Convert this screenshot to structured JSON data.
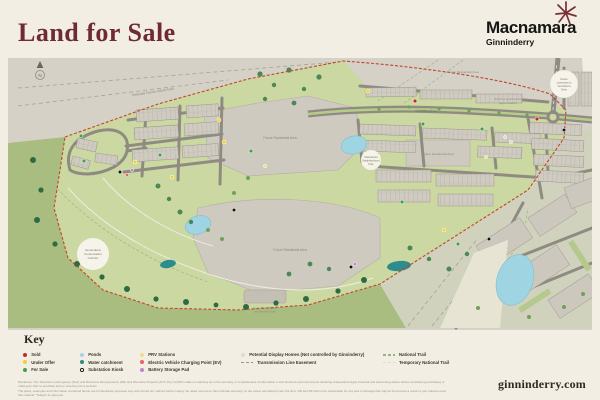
{
  "page": {
    "background": "#f2eee4"
  },
  "header": {
    "title": "Land for Sale",
    "title_color": "#6e2b33",
    "logo_name": "Macnamara",
    "logo_sub": "Ginninderry",
    "logo_star_color": "#7a2e35"
  },
  "map": {
    "compass": "N",
    "labels": {
      "potential_future_urban_area": "Potential Future Urban Area",
      "future_residential": "Future Residential Area",
      "future_local_centre": "Future Local Centre",
      "future_local_centre_sub": "(approx location)",
      "corridor_line1": "Ginninderra",
      "corridor_line2": "Conservation",
      "corridor_line3": "Corridor",
      "park_line1": "Macnamara",
      "park_line2": "Neighbourhood",
      "park_line3": "Park",
      "badge_line1": "Future",
      "badge_line2": "connection to",
      "badge_line3": "Ginninderra",
      "badge_line4": "Drive",
      "sewer_line1": "Sewer Pump Station",
      "sewer_line2": "and Network Store",
      "avenue": "Ginninderry Drive"
    },
    "colors": {
      "urban_gray": "#d6d1c7",
      "estate_park_green": "#ccd8a2",
      "corridor_green": "#a9bd80",
      "cleared_pale": "#d0d2bd",
      "pond_blue": "#9fd4e2",
      "catchment_teal": "#2d8c8c",
      "boundary_red": "#c1452c",
      "road_gray": "#8f8b83"
    }
  },
  "key": {
    "heading": "Key",
    "items": [
      {
        "label": "Sold",
        "color": "#c62828",
        "type": "dot"
      },
      {
        "label": "Under Offer",
        "color": "#f3d02f",
        "type": "dot"
      },
      {
        "label": "For Sale",
        "color": "#43a047",
        "type": "dot"
      },
      {
        "label": "Ponds",
        "color": "#a6d3e3",
        "type": "dot"
      },
      {
        "label": "Water catchment",
        "color": "#2d8c8c",
        "type": "dot"
      },
      {
        "label": "Substation Kiosk",
        "color": "#111111",
        "type": "kiosk"
      },
      {
        "label": "PRV Stations",
        "color": "#f2dc8c",
        "type": "dot"
      },
      {
        "label": "Electric Vehicle Charging Point (EV)",
        "color": "#e8655c",
        "type": "dot"
      },
      {
        "label": "Battery Storage Pad",
        "color": "#bb86c8",
        "type": "dot"
      },
      {
        "label": "Potential Display Homes (Not controlled by Ginninderry)",
        "color": "#dddbd2",
        "type": "dot"
      },
      {
        "label": "Transmission Line Easement",
        "color": "#9a958a",
        "type": "dash"
      },
      {
        "label": "National Trail",
        "color": "#93b687",
        "type": "dash"
      },
      {
        "label": "Temporary National Trail",
        "color": "#dfddc6",
        "type": "dash"
      }
    ]
  },
  "footer": {
    "disclaimer_line1": "Disclaimer: The Suburban Land Agency (SLA) and Riverview Developments (RD) and Riverview Projects (ACT) Pty Ltd (RP) make no warranty as to the accuracy or completeness of information in this brochure and recommend obtaining independent legal, financial and accounting advice before considering purchasing or making an offer to purchase land or entering into a contract.",
    "disclaimer_line2": "The plans, examples and information contained herein are for illustrative purposes only and should not, without further inquiry, be relied upon as to their ultimate accuracy; to the extent permitted by law, the SLA, RD and RP will not be responsible for any loss or damage that may be incurred as a result of your reliance upon this material. *Subject to approval.",
    "website": "ginninderry.com"
  }
}
